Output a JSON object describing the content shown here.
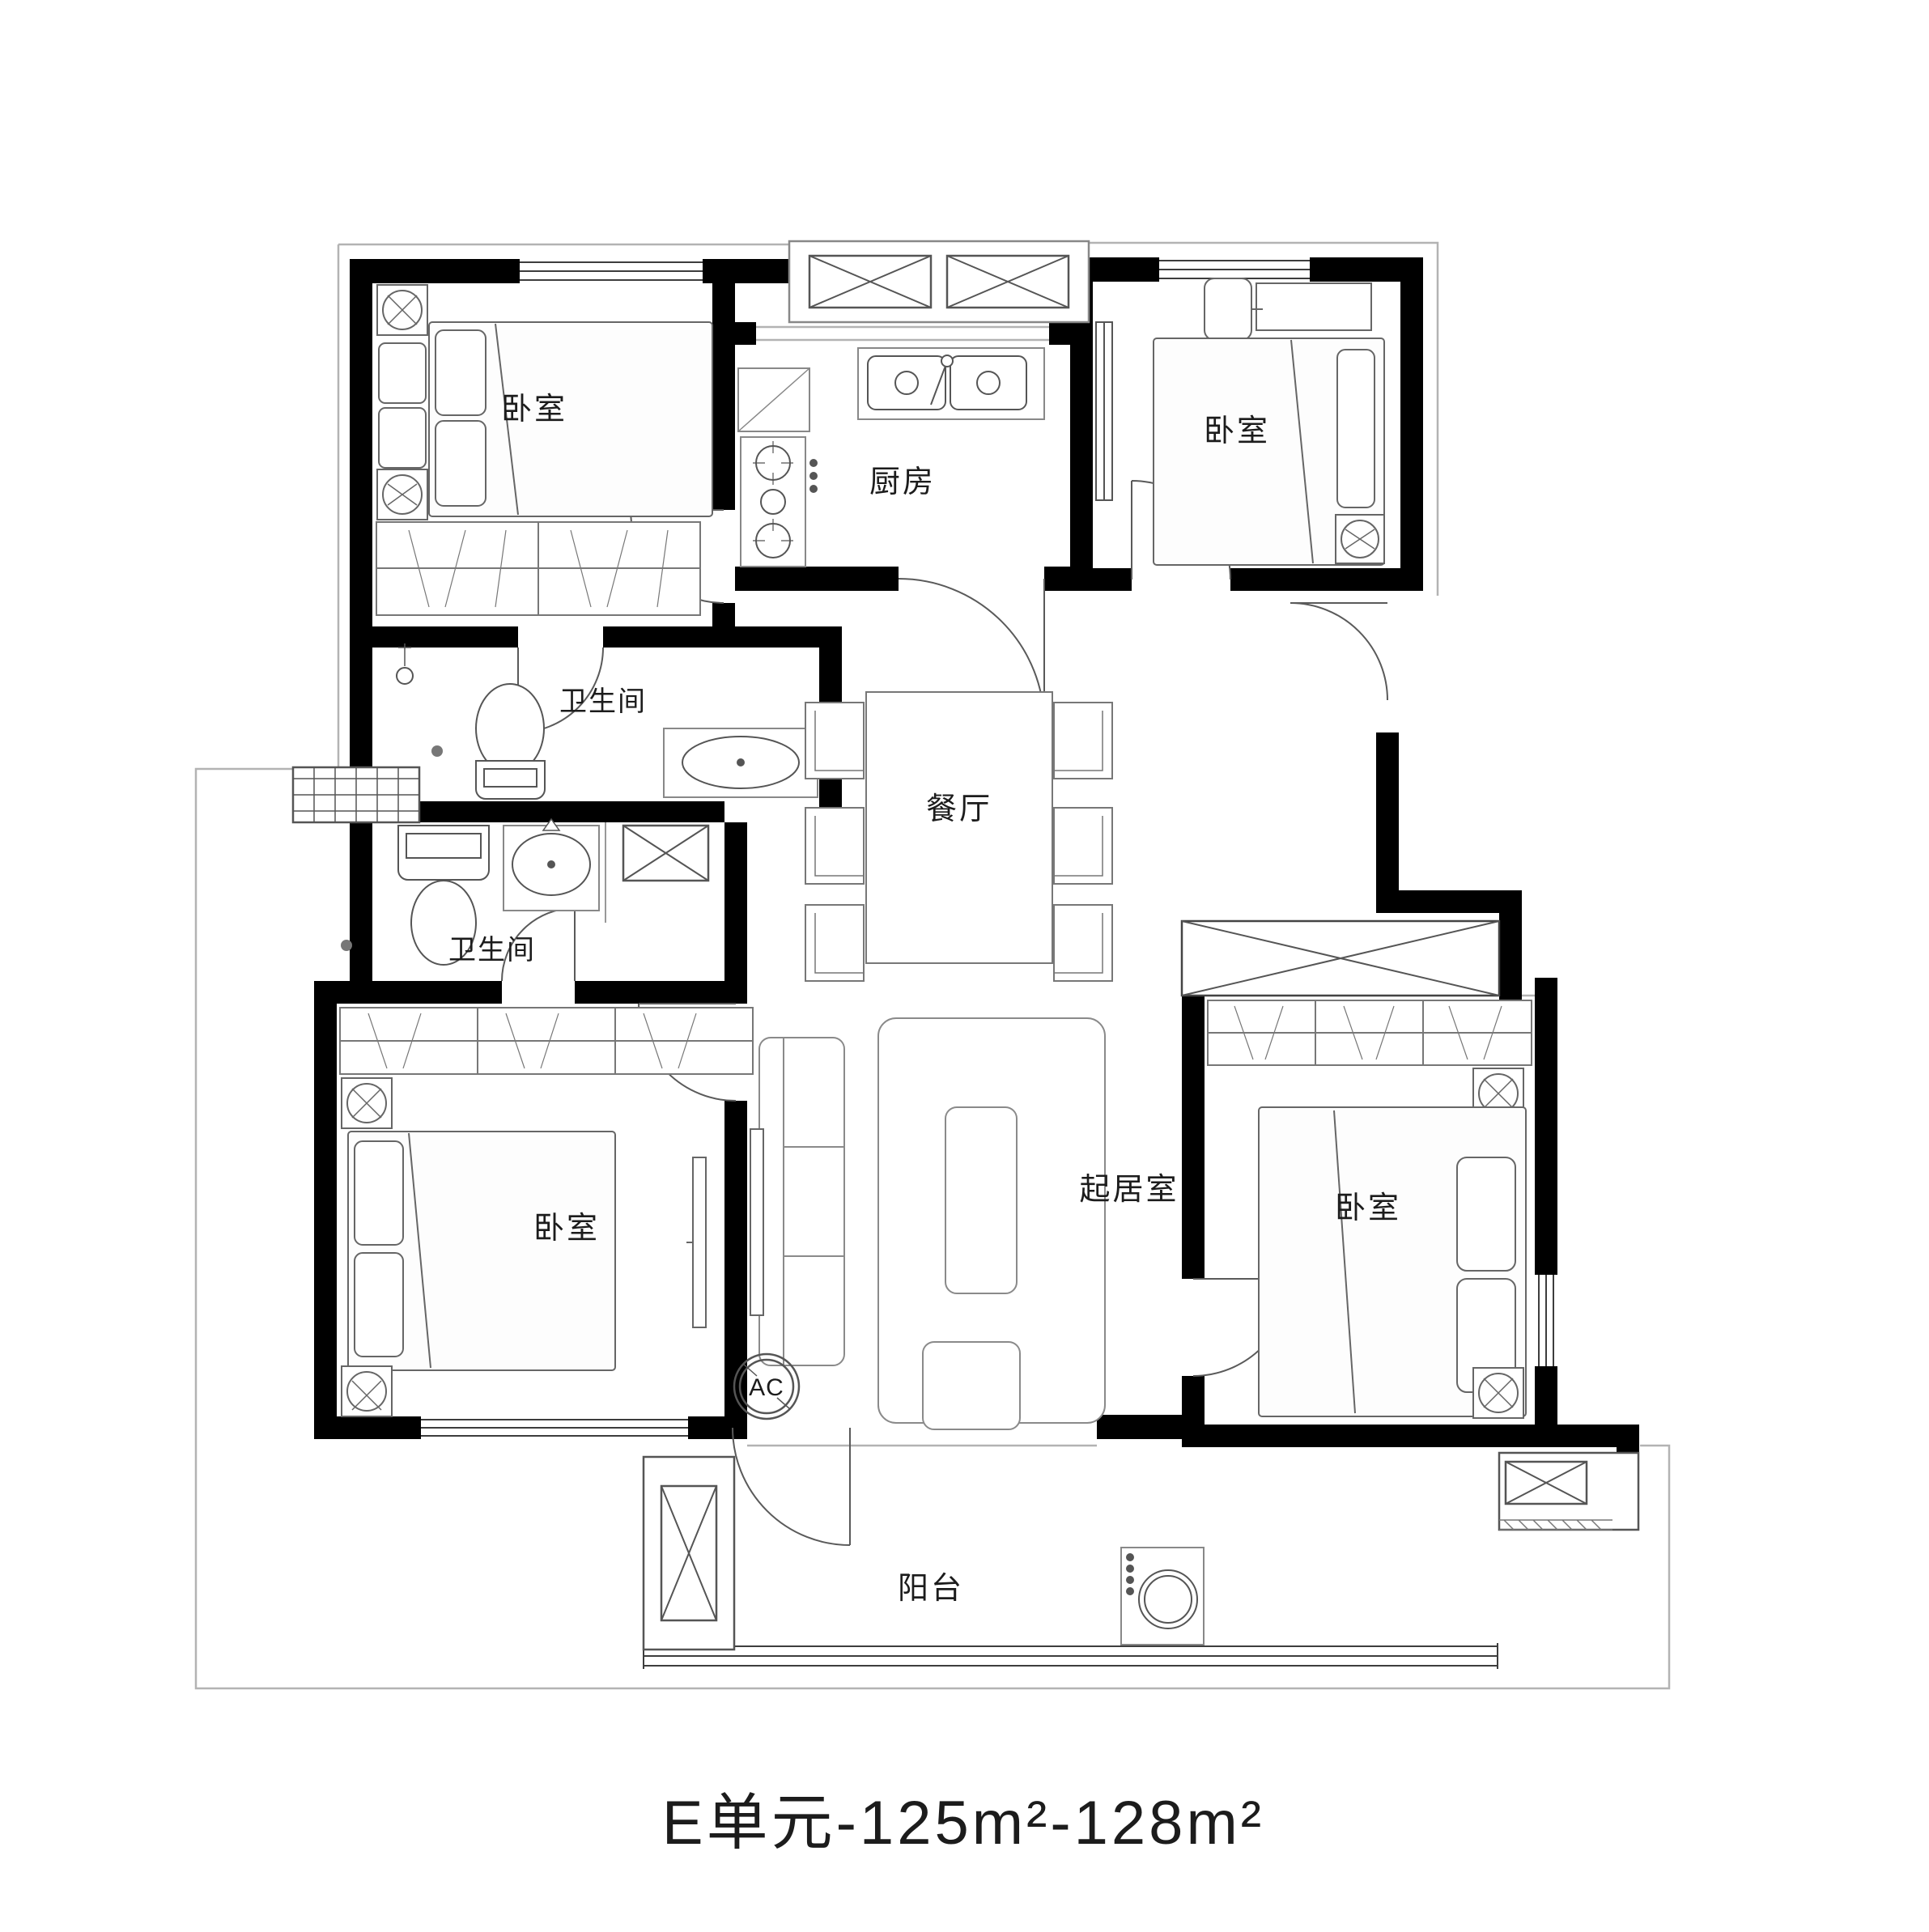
{
  "title": "E单元-125m²-128m²",
  "rooms": {
    "bedroom_nw": "卧室",
    "bedroom_ne": "卧室",
    "bedroom_sw": "卧室",
    "bedroom_se": "卧室",
    "kitchen": "厨房",
    "bathroom_upper": "卫生间",
    "bathroom_lower": "卫生间",
    "dining": "餐厅",
    "living": "起居室",
    "balcony": "阳台"
  },
  "annotations": {
    "ac": "AC"
  }
}
